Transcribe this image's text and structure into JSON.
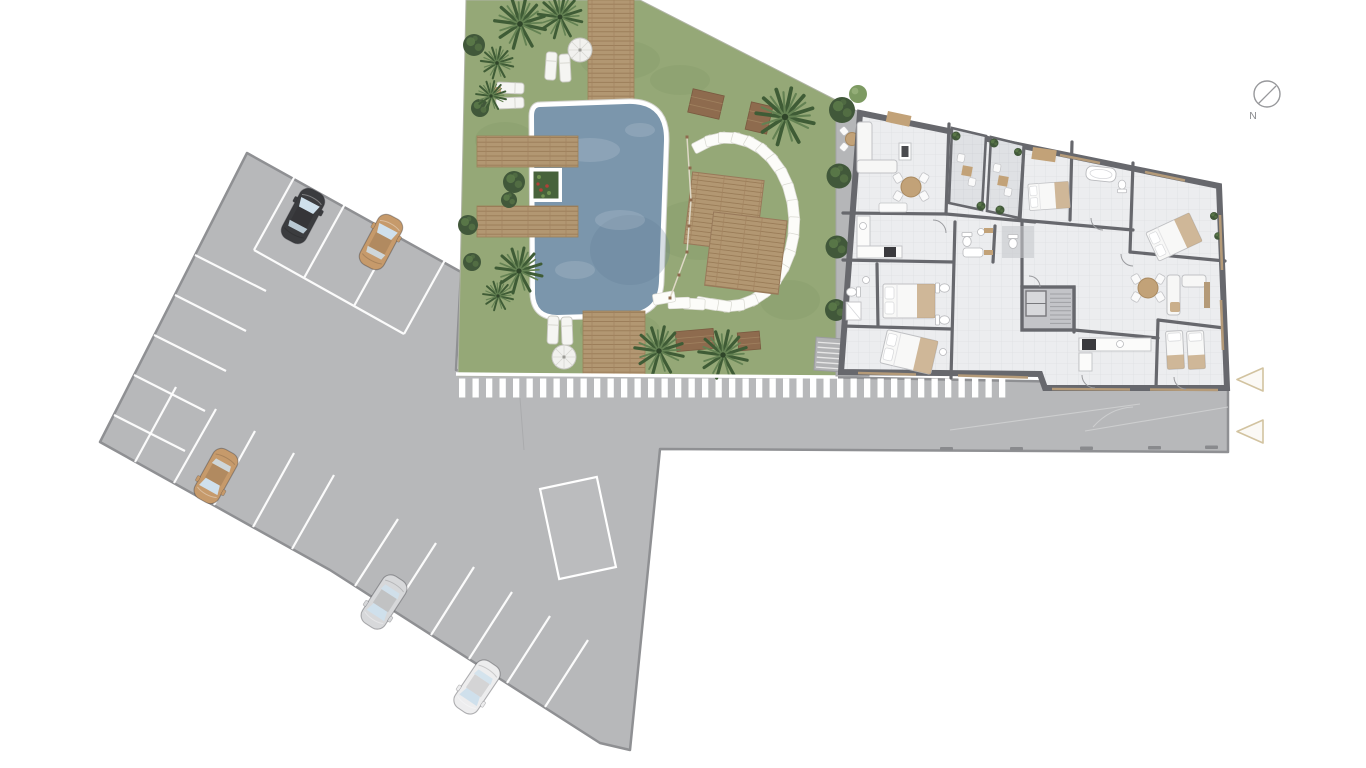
{
  "compass": {
    "label": "N"
  },
  "palette": {
    "bg": "#ffffff",
    "pavement": "#b7b8ba",
    "pavementBorder": "#8f9093",
    "stall": "#ffffff",
    "grass": "#95a877",
    "grassShade": "#76905c",
    "wood": "#b29772",
    "woodLine": "#977955",
    "woodDark": "#8e6b4e",
    "water": "#7b96ac",
    "waterDeep": "#5f7b93",
    "wall": "#67686d",
    "floor": "#ecedef",
    "floorLine": "#dfe0e3",
    "balcony": "#dfe1e4",
    "tan": "#c2a278",
    "windowTan": "#b49a78",
    "treeDark": "#41583a",
    "treeLight": "#5d7b4a",
    "palm": "#3f5c36",
    "palmLight": "#648253",
    "glass": "#cfe0ec",
    "marker": "#d2c3a0",
    "compassGray": "#97989b",
    "carDark": "#3b3c3f",
    "carTan": "#c69a6b",
    "carSilver": "#d7d8da",
    "carWhite": "#ededee",
    "stepsGray": "#b2b3b5"
  },
  "site": {
    "parking": {
      "rows": [
        {
          "id": "top-row",
          "stalls": 5,
          "occupied": 2
        },
        {
          "id": "left-row",
          "stalls": 4,
          "occupied": 0
        },
        {
          "id": "bottom-row",
          "stalls": 11,
          "occupied": 3
        }
      ],
      "cars": [
        {
          "id": "car-1",
          "color_name": "dark-gray",
          "row": "top-row"
        },
        {
          "id": "car-2",
          "color_name": "tan",
          "row": "top-row"
        },
        {
          "id": "car-3",
          "color_name": "tan",
          "row": "bottom-row"
        },
        {
          "id": "car-4",
          "color_name": "silver",
          "row": "bottom-row"
        },
        {
          "id": "car-5",
          "color_name": "white",
          "row": "bottom-row"
        }
      ],
      "reserved_marked_spaces": 1
    },
    "amenities": {
      "pool": 1,
      "umbrellas": 2,
      "sun_loungers": 6,
      "stepping_stones": 23,
      "wood_platforms": 2,
      "wood_benches": 4,
      "palm_trees": 9,
      "balconies": 2
    },
    "entrance_markers": 2
  }
}
